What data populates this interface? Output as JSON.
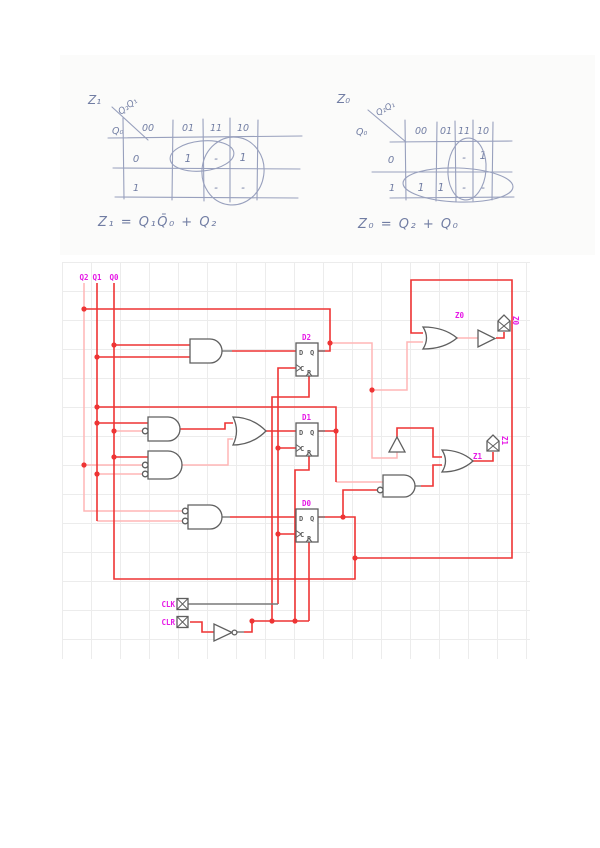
{
  "kmaps": {
    "z1": {
      "title": "Z₁",
      "axis_top": "Q₂Q₁",
      "axis_side": "Q₀",
      "col_headers": [
        "00",
        "01",
        "11",
        "10"
      ],
      "row_headers": [
        "0",
        "1"
      ],
      "cells": [
        [
          "",
          "1",
          "-",
          "1"
        ],
        [
          "",
          "",
          "-",
          "-"
        ]
      ],
      "equation": "Z₁ = Q₁Q̄₀ + Q₂"
    },
    "z0": {
      "title": "Z₀",
      "axis_top": "Q₂Q₁",
      "axis_side": "Q₀",
      "col_headers": [
        "00",
        "01",
        "11",
        "10"
      ],
      "row_headers": [
        "0",
        "1"
      ],
      "cells": [
        [
          "",
          "",
          "-",
          "1"
        ],
        [
          "1",
          "1",
          "-",
          "-"
        ]
      ],
      "equation": "Z₀ = Q₂ + Q₀"
    }
  },
  "circuit": {
    "rail_labels": [
      "Q2",
      "Q1",
      "Q0"
    ],
    "flipflops": [
      {
        "label": "D2"
      },
      {
        "label": "D1"
      },
      {
        "label": "D0"
      }
    ],
    "ff_pin_letters": {
      "d": "D",
      "q": "Q",
      "c": "C",
      "r": "R"
    },
    "inputs": [
      {
        "label": "CLK"
      },
      {
        "label": "CLR"
      }
    ],
    "outputs": [
      {
        "label": "Z0"
      },
      {
        "label": "Z1"
      }
    ],
    "or_gate_label_z0": "Z0",
    "or_gate_label_z1": "Z1",
    "colors": {
      "wire_high": "#ee3434",
      "wire_low": "#ffb6b6",
      "label_magenta": "#e619e6",
      "component_gray": "#5f5f5f"
    }
  }
}
